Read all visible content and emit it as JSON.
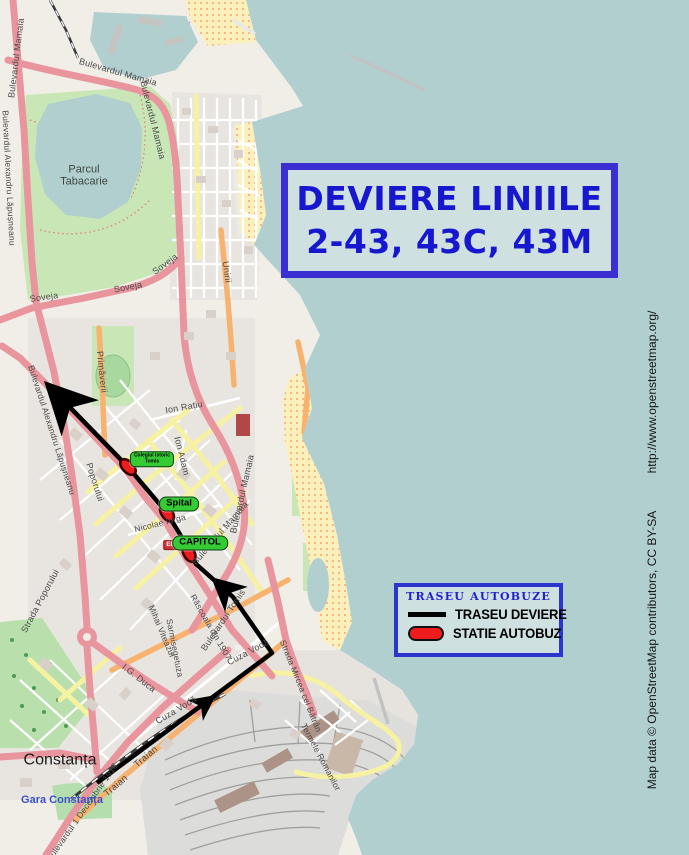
{
  "title_box": {
    "line1": "DEVIERE LINIILE",
    "line2": "2-43, 43C, 43M"
  },
  "legend": {
    "title": "TRASEU AUTOBUZE",
    "items": [
      {
        "type": "line",
        "label": "TRASEU DEVIERE"
      },
      {
        "type": "station",
        "label": "STATIE AUTOBUZ"
      }
    ]
  },
  "attribution": {
    "url": "http://www.openstreetmap.org/",
    "credit": "Map data © OpenStreetMap contributors, CC BY-SA"
  },
  "map": {
    "colors": {
      "sea": "#b2cfd0",
      "land": "#f1eee8",
      "box_border": "#3b2fd4",
      "box_bg": "#cfe0e0",
      "title_text": "#1717cf",
      "legend_title": "#2222cc",
      "route": "#000000",
      "station_fill": "#ee1c1c",
      "station_stroke": "#3a0000",
      "station_label_bg": "#35cb35"
    },
    "city_labels": [
      {
        "text": "Constanța",
        "x": 60,
        "y": 761,
        "size": 16,
        "color": "#1c1c1c",
        "bold": false
      },
      {
        "text": "Gara Constanța",
        "x": 62,
        "y": 801,
        "size": 11,
        "color": "#3c50c8",
        "bold": true
      },
      {
        "text": "Parcul\nTabacarie",
        "x": 84,
        "y": 176,
        "size": 11,
        "color": "#3d453d",
        "bold": false
      }
    ],
    "street_labels": [
      {
        "text": "Bulevardul Mamaia",
        "x": 16,
        "y": 58,
        "rot": -83,
        "size": 9
      },
      {
        "text": "Bulevardul Mamaia",
        "x": 118,
        "y": 72,
        "rot": 16,
        "size": 9
      },
      {
        "text": "Bulevardul Mamaia",
        "x": 153,
        "y": 120,
        "rot": 76,
        "size": 9
      },
      {
        "text": "Bulevardul Alexandru Lăpușneanu",
        "x": 9,
        "y": 178,
        "rot": 87,
        "size": 8.5
      },
      {
        "text": "Bulevardul Alexandru Lăpușneanu",
        "x": 52,
        "y": 430,
        "rot": 72,
        "size": 8.5
      },
      {
        "text": "Soveja",
        "x": 44,
        "y": 297,
        "rot": -8,
        "size": 9
      },
      {
        "text": "Soveja",
        "x": 128,
        "y": 287,
        "rot": -11,
        "size": 9
      },
      {
        "text": "Soveja",
        "x": 165,
        "y": 264,
        "rot": -36,
        "size": 9
      },
      {
        "text": "Unirii",
        "x": 227,
        "y": 272,
        "rot": 82,
        "size": 9
      },
      {
        "text": "Primăverii",
        "x": 102,
        "y": 372,
        "rot": 84,
        "size": 9
      },
      {
        "text": "Ion Rațiu",
        "x": 184,
        "y": 407,
        "rot": -10,
        "size": 9
      },
      {
        "text": "Ion Adam",
        "x": 182,
        "y": 456,
        "rot": 76,
        "size": 9
      },
      {
        "text": "Poporului",
        "x": 95,
        "y": 482,
        "rot": 72,
        "size": 9
      },
      {
        "text": "Strada Poporului",
        "x": 40,
        "y": 601,
        "rot": -62,
        "size": 9
      },
      {
        "text": "Nicolae Iorga",
        "x": 160,
        "y": 523,
        "rot": -14,
        "size": 8.5
      },
      {
        "text": "Bulevardul Mamaia",
        "x": 242,
        "y": 494,
        "rot": -77,
        "size": 9
      },
      {
        "text": "Bulevardul Mamaia",
        "x": 220,
        "y": 533,
        "rot": -49,
        "size": 9
      },
      {
        "text": "Bulevardul Tomis",
        "x": 223,
        "y": 620,
        "rot": -56,
        "size": 9
      },
      {
        "text": "Răscoala din 1907",
        "x": 211,
        "y": 627,
        "rot": 60,
        "size": 8.5
      },
      {
        "text": "Mihai Viteazul",
        "x": 162,
        "y": 631,
        "rot": 67,
        "size": 8.5
      },
      {
        "text": "Sarmisegetuza",
        "x": 175,
        "y": 648,
        "rot": 79,
        "size": 8.5
      },
      {
        "text": "Cuza Vodă",
        "x": 248,
        "y": 652,
        "rot": -28,
        "size": 9
      },
      {
        "text": "Cuza Vodă",
        "x": 176,
        "y": 710,
        "rot": -31,
        "size": 9
      },
      {
        "text": "Strada Mircea cel Bătrân",
        "x": 301,
        "y": 686,
        "rot": 68,
        "size": 8.5
      },
      {
        "text": "Traian",
        "x": 146,
        "y": 757,
        "rot": -40,
        "size": 9.5
      },
      {
        "text": "Traian",
        "x": 116,
        "y": 786,
        "rot": -40,
        "size": 9.5
      },
      {
        "text": "Bulevardul 1 Decembrie 1918",
        "x": 82,
        "y": 812,
        "rot": -55,
        "size": 8.5
      },
      {
        "text": "Termele Romanilor",
        "x": 321,
        "y": 757,
        "rot": 62,
        "size": 8.5
      },
      {
        "text": "I.G. Duca",
        "x": 139,
        "y": 678,
        "rot": 38,
        "size": 9
      }
    ],
    "road_shields": [
      {
        "text": "E87",
        "x": 172,
        "y": 545
      }
    ],
    "route": {
      "color": "#000000",
      "width": 4.5,
      "points": [
        [
          97,
          783
        ],
        [
          272,
          653
        ],
        [
          233,
          597
        ],
        [
          196,
          564
        ],
        [
          184,
          541
        ],
        [
          167,
          513
        ],
        [
          128,
          467
        ],
        [
          55,
          392
        ]
      ],
      "arrows": [
        {
          "x": 216,
          "y": 695,
          "angle": -36.6,
          "len": 26,
          "halfw": 13
        },
        {
          "x": 211,
          "y": 577,
          "angle": -138.3,
          "len": 34,
          "halfw": 17
        },
        {
          "x": 44,
          "y": 381,
          "angle": -134.2,
          "len": 52,
          "halfw": 26
        }
      ]
    },
    "stations": [
      {
        "x": 128,
        "y": 467,
        "rot": 46,
        "label": "Colegiul Istoric\nTomis",
        "lx": 152,
        "ly": 459,
        "small": true
      },
      {
        "x": 167,
        "y": 513,
        "rot": 56,
        "label": "Spital",
        "lx": 179,
        "ly": 504,
        "small": false
      },
      {
        "x": 189,
        "y": 553,
        "rot": 63,
        "label": "CAPITOL",
        "lx": 200,
        "ly": 543,
        "small": false
      }
    ]
  }
}
